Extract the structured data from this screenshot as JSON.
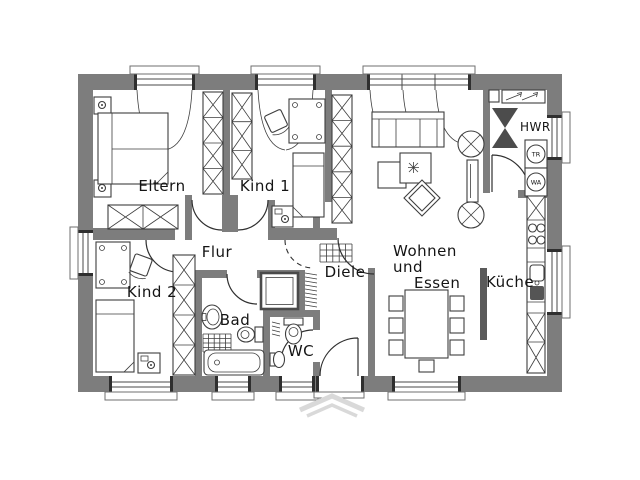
{
  "title": "Grundriss Erdgeschoss (floor plan)",
  "colors": {
    "wall": "#7d7d7d",
    "line": "#3e3e3e",
    "fixture_dark": "#4c4c4c",
    "entrance_marker": "#d9d9d9",
    "background": "#ffffff"
  },
  "rooms": {
    "eltern": "Eltern",
    "kind1": "Kind 1",
    "kind2": "Kind 2",
    "flur": "Flur",
    "diele": "Diele",
    "bad": "Bad",
    "wc": "WC",
    "wohnen_line1": "Wohnen",
    "wohnen_line2": "und",
    "wohnen_line3": "Essen",
    "kueche": "Küche",
    "hwr": "HWR"
  },
  "appliances": {
    "dryer": "TR",
    "washer": "WA"
  }
}
